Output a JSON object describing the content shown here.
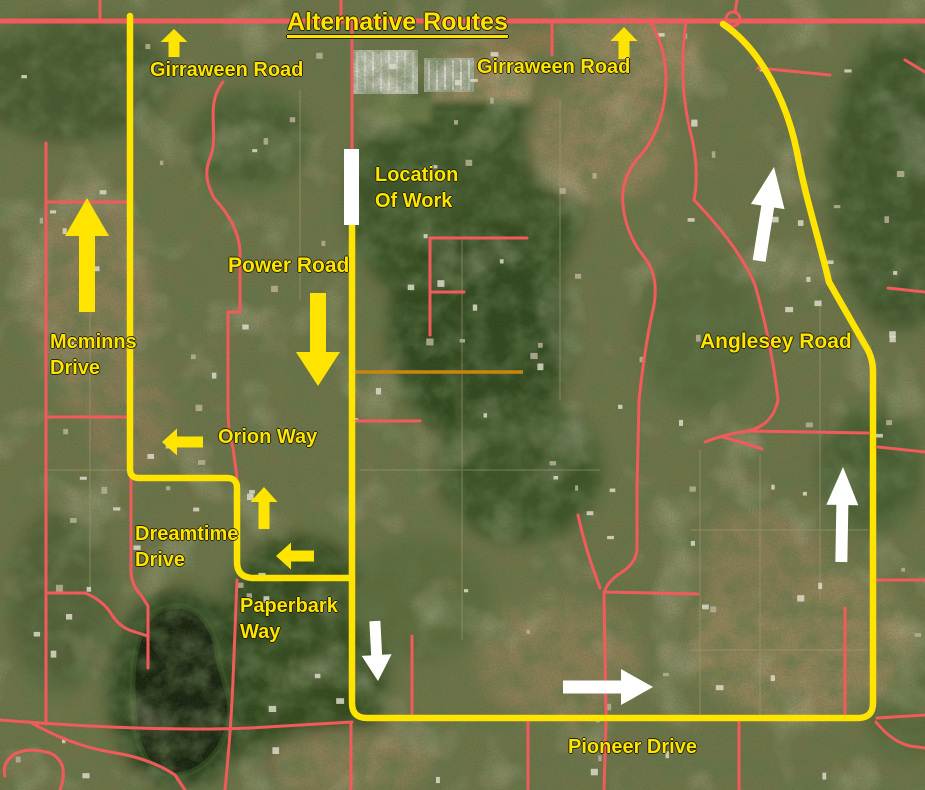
{
  "title": "Alternative Routes",
  "colors": {
    "route": "#ffe400",
    "road": "#f15b5b",
    "alt_road": "#c8860e",
    "label": "#ffe400",
    "arrow_yellow": "#ffe400",
    "arrow_white": "#ffffff",
    "work_marker": "#ffffff"
  },
  "labels": [
    {
      "id": "girraween-road-west",
      "text": "Girraween Road",
      "x": 150,
      "y": 58,
      "size": 20
    },
    {
      "id": "girraween-road-east",
      "text": "Girraween Road",
      "x": 477,
      "y": 55,
      "size": 20
    },
    {
      "id": "location-of-work",
      "text": "Location\nOf Work",
      "x": 375,
      "y": 163,
      "size": 20
    },
    {
      "id": "power-road",
      "text": "Power Road",
      "x": 228,
      "y": 253,
      "size": 21
    },
    {
      "id": "mcminns-drive",
      "text": "Mcminns\nDrive",
      "x": 50,
      "y": 330,
      "size": 20
    },
    {
      "id": "orion-way",
      "text": "Orion Way",
      "x": 218,
      "y": 425,
      "size": 20
    },
    {
      "id": "dreamtime-drive",
      "text": "Dreamtime\nDrive",
      "x": 135,
      "y": 522,
      "size": 20
    },
    {
      "id": "paperbark-way",
      "text": "Paperbark\nWay",
      "x": 240,
      "y": 594,
      "size": 20
    },
    {
      "id": "anglesey-road",
      "text": "Anglesey Road",
      "x": 700,
      "y": 329,
      "size": 21
    },
    {
      "id": "pioneer-drive",
      "text": "Pioneer Drive",
      "x": 568,
      "y": 735,
      "size": 20
    }
  ],
  "arrows": [
    {
      "id": "girraween-west-up-arrow",
      "color": "yellow",
      "dir": "up",
      "tip": [
        174,
        29
      ],
      "len": 28,
      "shaft": 11,
      "headLen": 13,
      "headW": 27,
      "rot": 0
    },
    {
      "id": "girraween-east-up-arrow",
      "color": "yellow",
      "dir": "up",
      "tip": [
        624,
        27
      ],
      "len": 32,
      "shaft": 11,
      "headLen": 14,
      "headW": 27,
      "rot": 0
    },
    {
      "id": "mcminns-up-arrow",
      "color": "yellow",
      "dir": "up",
      "tip": [
        87,
        198
      ],
      "len": 114,
      "shaft": 16,
      "headLen": 38,
      "headW": 44,
      "rot": 0
    },
    {
      "id": "power-road-down-arrow",
      "color": "yellow",
      "dir": "down",
      "tip": [
        318,
        386
      ],
      "len": 93,
      "shaft": 16,
      "headLen": 34,
      "headW": 44,
      "rot": 0
    },
    {
      "id": "orion-way-left-arrow",
      "color": "yellow",
      "dir": "left",
      "tip": [
        162,
        442
      ],
      "len": 41,
      "shaft": 11,
      "headLen": 15,
      "headW": 27,
      "rot": 0
    },
    {
      "id": "paperbark-up-arrow",
      "color": "yellow",
      "dir": "up",
      "tip": [
        264,
        487
      ],
      "len": 42,
      "shaft": 11,
      "headLen": 15,
      "headW": 27,
      "rot": 0
    },
    {
      "id": "paperbark-left-arrow",
      "color": "yellow",
      "dir": "left",
      "tip": [
        276,
        556
      ],
      "len": 38,
      "shaft": 11,
      "headLen": 15,
      "headW": 27,
      "rot": 0
    },
    {
      "id": "anglesey-up-arrow-north",
      "color": "white",
      "dir": "up",
      "tip": [
        774,
        167
      ],
      "len": 95,
      "shaft": 13,
      "headLen": 40,
      "headW": 34,
      "rot": 9
    },
    {
      "id": "anglesey-up-arrow-south",
      "color": "white",
      "dir": "up",
      "tip": [
        843,
        467
      ],
      "len": 95,
      "shaft": 12,
      "headLen": 38,
      "headW": 32,
      "rot": 1
    },
    {
      "id": "pioneer-down-arrow",
      "color": "white",
      "dir": "down",
      "tip": [
        378,
        681
      ],
      "len": 60,
      "shaft": 11,
      "headLen": 26,
      "headW": 30,
      "rot": -3
    },
    {
      "id": "pioneer-right-arrow",
      "color": "white",
      "dir": "right",
      "tip": [
        653,
        687
      ],
      "len": 90,
      "shaft": 13,
      "headLen": 32,
      "headW": 36,
      "rot": 0
    }
  ],
  "work_marker": {
    "x": 344,
    "y": 149,
    "w": 15,
    "h": 76
  },
  "roundabout": {
    "cx": 733,
    "cy": 19,
    "r": 7
  }
}
